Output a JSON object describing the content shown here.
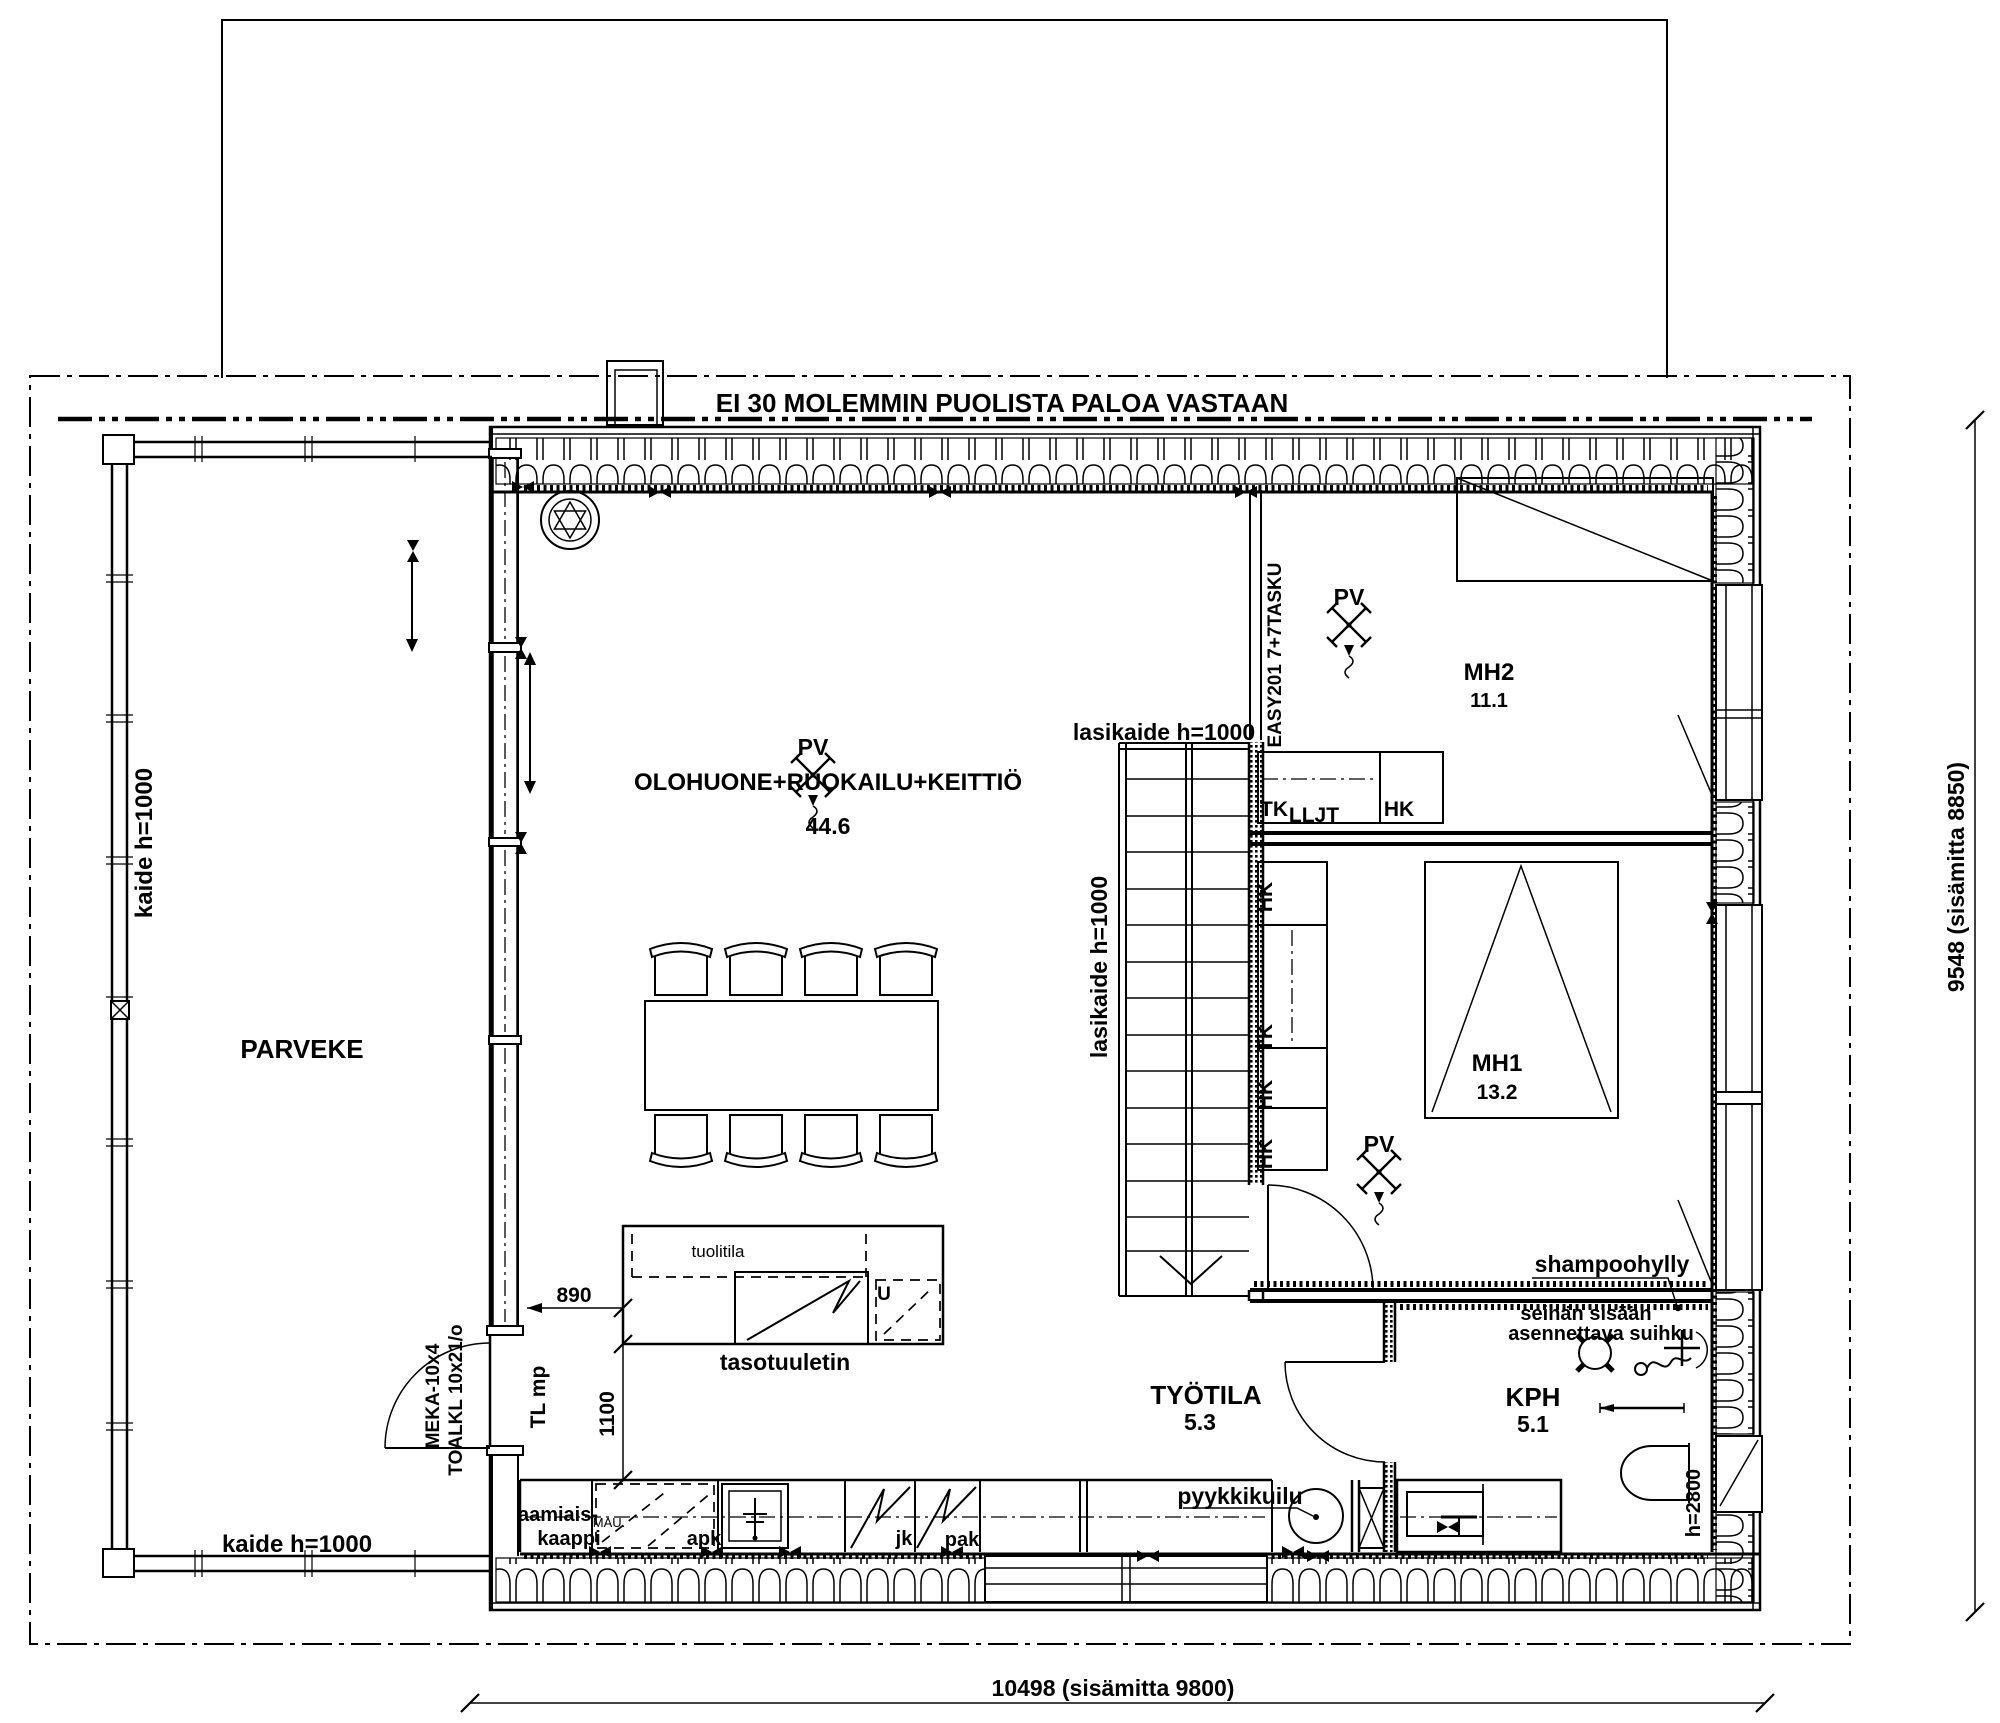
{
  "drawing": {
    "fire_rating_note": "EI 30 MOLEMMIN PUOLISTA PALOA VASTAAN",
    "rooms": {
      "balcony": {
        "name": "PARVEKE"
      },
      "living": {
        "name": "OLOHUONE+RUOKAILU+KEITTIÖ",
        "area": "44.6"
      },
      "bedroom2": {
        "name": "MH2",
        "area": "11.1"
      },
      "bedroom1": {
        "name": "MH1",
        "area": "13.2"
      },
      "bathroom": {
        "name": "KPH",
        "area": "5.1"
      },
      "workspace": {
        "name": "TYÖTILA",
        "area": "5.3"
      }
    },
    "railings": {
      "balcony_left": "kaide h=1000",
      "balcony_bottom": "kaide h=1000",
      "stairs_top": "lasikaide h=1000",
      "stairs_left": "lasikaide h=1000"
    },
    "fixtures": {
      "pv": "PV",
      "tk": "TK",
      "lljt": "LLJT",
      "hk": "HK",
      "shampoo_shelf": "shampoohylly",
      "shower_note_line1": "seinän sisään",
      "shower_note_line2": "asennettava suihku",
      "laundry_chute": "pyykkikuilu",
      "counter_fan": "tasotuuletin",
      "chair_space": "tuolitila",
      "breakfast_cabinet_line1": "aamiais-",
      "breakfast_cabinet_line2": "kaappi",
      "mau": "MAU.",
      "dishwasher": "apk",
      "fridge": "jk",
      "freezer": "pak",
      "u_mark": "U",
      "tl_mp": "TL mp",
      "door_code_1": "MEKA-10x4",
      "door_code_2": "TOALKL 10x21/o",
      "sliding_door_code": "EASY201 7+7TASKU",
      "ceiling_height": "h=2800"
    },
    "dimensions": {
      "overall_width": "10498 (sisämitta 9800)",
      "overall_height": "9548 (sisämitta 8850)",
      "island_offset": "890",
      "island_clearance": "1100"
    }
  }
}
